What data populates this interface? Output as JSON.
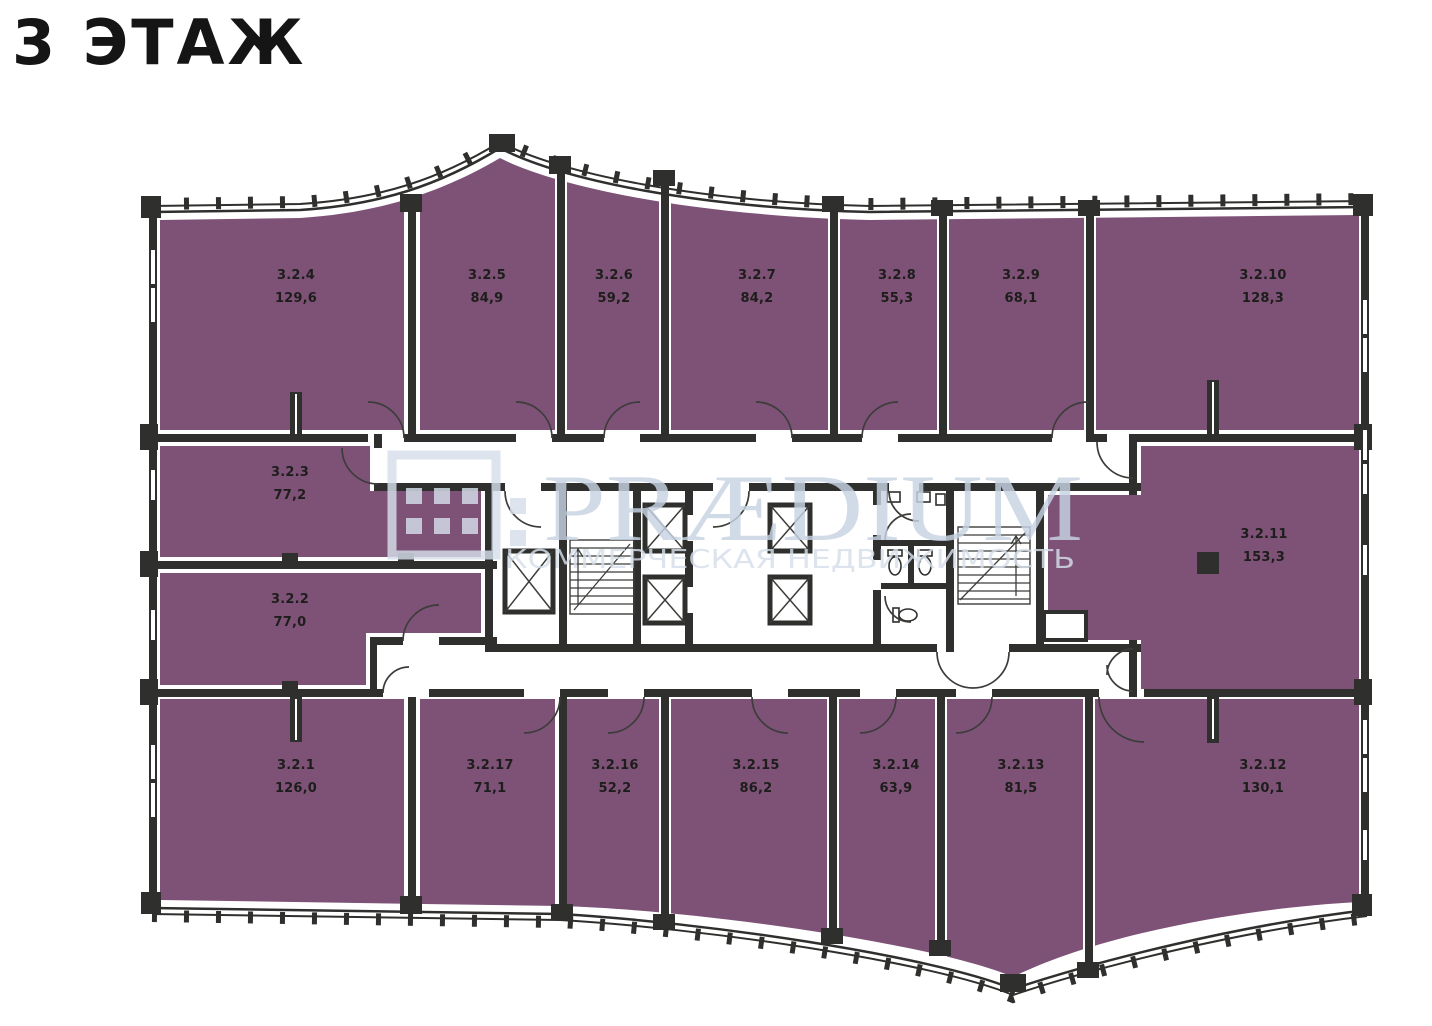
{
  "title": "3 ЭТАЖ",
  "watermark": {
    "brand": "PRÆDIUM",
    "tagline": "КОММЕРЧЕСКАЯ НЕДВИЖИМОСТЬ"
  },
  "colors": {
    "room_fill": "#7e5277",
    "wall": "#2f2f2d",
    "watermark_text": "#c8d4e4",
    "watermark_light": "#d6dfeb"
  },
  "rooms": [
    {
      "id": "3.2.4",
      "area": "129,6"
    },
    {
      "id": "3.2.5",
      "area": "84,9"
    },
    {
      "id": "3.2.6",
      "area": "59,2"
    },
    {
      "id": "3.2.7",
      "area": "84,2"
    },
    {
      "id": "3.2.8",
      "area": "55,3"
    },
    {
      "id": "3.2.9",
      "area": "68,1"
    },
    {
      "id": "3.2.10",
      "area": "128,3"
    },
    {
      "id": "3.2.3",
      "area": "77,2"
    },
    {
      "id": "3.2.2",
      "area": "77,0"
    },
    {
      "id": "3.2.11",
      "area": "153,3"
    },
    {
      "id": "3.2.1",
      "area": "126,0"
    },
    {
      "id": "3.2.17",
      "area": "71,1"
    },
    {
      "id": "3.2.16",
      "area": "52,2"
    },
    {
      "id": "3.2.15",
      "area": "86,2"
    },
    {
      "id": "3.2.14",
      "area": "63,9"
    },
    {
      "id": "3.2.13",
      "area": "81,5"
    },
    {
      "id": "3.2.12",
      "area": "130,1"
    }
  ]
}
